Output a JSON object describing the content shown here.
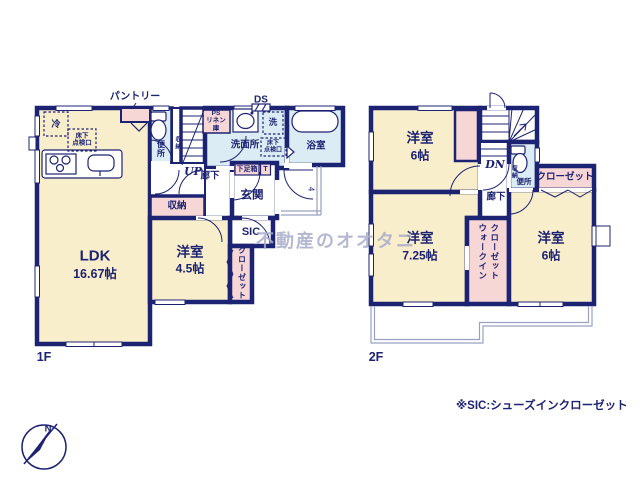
{
  "watermark": "不動産のオオタニ",
  "footnote": "※SIC:シューズインクローゼット",
  "compass": {
    "north": "N"
  },
  "palette": {
    "wall": "#1d2373",
    "room_cream": "#f8eecb",
    "room_pink": "#f7d6d6",
    "room_blue": "#dbecf5",
    "watermark": "#a9accc"
  },
  "floor1": {
    "label": "1F",
    "pantry": "パントリー",
    "duct": "DS",
    "fridge": "冷",
    "floor_hatch": "床下\n点検口",
    "toilet": "便所",
    "toilet_storage": "収納",
    "stairs_up": "UP",
    "ps_linen": "PS\nリネン\n庫",
    "washroom": "洗面所",
    "washer": "洗",
    "washroom_hatch": "床下\n点検口",
    "bathroom": "浴室",
    "hallway": "廊下",
    "shoe_box": "下足箱",
    "shoe_t": "T",
    "entrance": "玄関",
    "entrance_steps": "4",
    "storage": "収納",
    "sic": "SIC",
    "ldk": {
      "name": "LDK",
      "size": "16.67帖"
    },
    "bedroom": {
      "name": "洋室",
      "size": "4.5帖"
    },
    "closet": "クローゼット"
  },
  "floor2": {
    "label": "2F",
    "stairs_down": "DN",
    "hallway": "廊下",
    "toilet": "便所",
    "toilet_storage": "収納",
    "closet": "クローゼット",
    "wic_line1": "ウォークイン",
    "wic_line2": "クローゼット",
    "bedroom1": {
      "name": "洋室",
      "size": "6帖"
    },
    "bedroom2": {
      "name": "洋室",
      "size": "7.25帖"
    },
    "bedroom3": {
      "name": "洋室",
      "size": "6帖"
    }
  }
}
